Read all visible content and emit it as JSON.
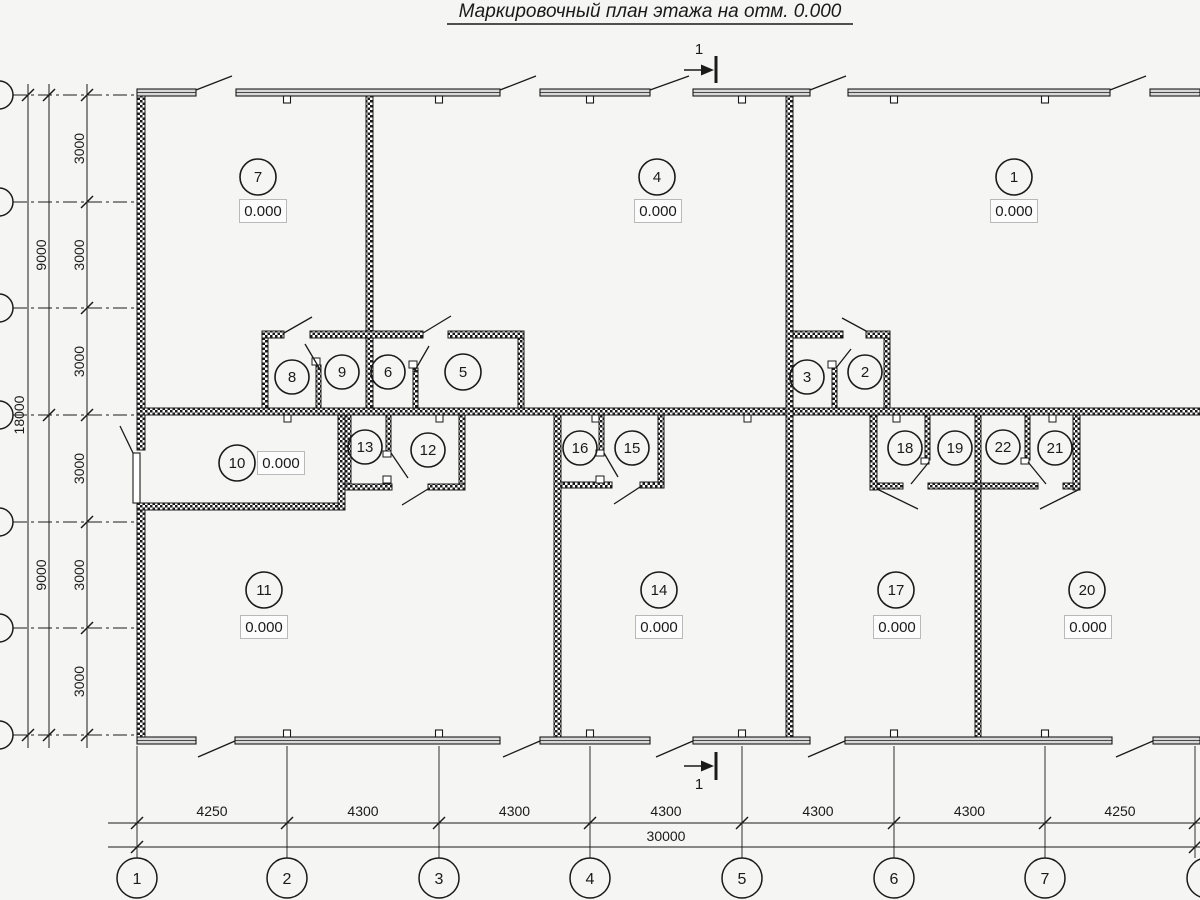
{
  "title": "Маркировочный план этажа на отм. 0.000",
  "section_mark": {
    "label": "1"
  },
  "colors": {
    "background": "#f5f5f3",
    "line": "#1a1a1a",
    "band_fill": "#d8d8d8",
    "elevation_box_fill": "#fcfcfc",
    "elevation_box_border": "#b9b9b9"
  },
  "rooms": [
    {
      "number": "7",
      "cx": 258,
      "cy": 177,
      "r": 18,
      "elevation": "0.000",
      "ex": 263,
      "ey": 211
    },
    {
      "number": "4",
      "cx": 657,
      "cy": 177,
      "r": 18,
      "elevation": "0.000",
      "ex": 658,
      "ey": 211
    },
    {
      "number": "1",
      "cx": 1014,
      "cy": 177,
      "r": 18,
      "elevation": "0.000",
      "ex": 1014,
      "ey": 211
    },
    {
      "number": "8",
      "cx": 292,
      "cy": 377,
      "r": 17
    },
    {
      "number": "9",
      "cx": 342,
      "cy": 372,
      "r": 17
    },
    {
      "number": "6",
      "cx": 388,
      "cy": 372,
      "r": 17
    },
    {
      "number": "5",
      "cx": 463,
      "cy": 372,
      "r": 18
    },
    {
      "number": "3",
      "cx": 807,
      "cy": 377,
      "r": 17
    },
    {
      "number": "2",
      "cx": 865,
      "cy": 372,
      "r": 17
    },
    {
      "number": "10",
      "cx": 237,
      "cy": 463,
      "r": 18,
      "elevation": "0.000",
      "ex": 281,
      "ey": 463
    },
    {
      "number": "13",
      "cx": 365,
      "cy": 447,
      "r": 17
    },
    {
      "number": "12",
      "cx": 428,
      "cy": 450,
      "r": 17
    },
    {
      "number": "16",
      "cx": 580,
      "cy": 448,
      "r": 17
    },
    {
      "number": "15",
      "cx": 632,
      "cy": 448,
      "r": 17
    },
    {
      "number": "18",
      "cx": 905,
      "cy": 448,
      "r": 17
    },
    {
      "number": "19",
      "cx": 955,
      "cy": 448,
      "r": 17
    },
    {
      "number": "22",
      "cx": 1003,
      "cy": 447,
      "r": 17
    },
    {
      "number": "21",
      "cx": 1055,
      "cy": 448,
      "r": 17
    },
    {
      "number": "11",
      "cx": 264,
      "cy": 590,
      "r": 18,
      "elevation": "0.000",
      "ex": 264,
      "ey": 627
    },
    {
      "number": "14",
      "cx": 659,
      "cy": 590,
      "r": 18,
      "elevation": "0.000",
      "ex": 659,
      "ey": 627
    },
    {
      "number": "17",
      "cx": 896,
      "cy": 590,
      "r": 18,
      "elevation": "0.000",
      "ex": 897,
      "ey": 627
    },
    {
      "number": "20",
      "cx": 1087,
      "cy": 590,
      "r": 18,
      "elevation": "0.000",
      "ex": 1088,
      "ey": 627
    }
  ],
  "left_axes": {
    "rows_y": [
      95,
      202,
      308,
      415,
      522,
      628,
      735
    ],
    "cx": -1,
    "r": 14
  },
  "left_dimensions": {
    "inner": {
      "x": 87,
      "label_x": 84,
      "labels": [
        "3000",
        "3000",
        "3000",
        "3000",
        "3000",
        "3000"
      ]
    },
    "middle": {
      "x": 49,
      "label_x": 46,
      "spans": [
        {
          "label": "9000",
          "y1": 95,
          "y2": 415
        },
        {
          "label": "9000",
          "y1": 415,
          "y2": 735
        }
      ]
    },
    "outer": {
      "x": 28,
      "label_x": 24,
      "label": "18000",
      "label_y": 415
    }
  },
  "bottom_axes": {
    "cy": 878,
    "r": 20,
    "circles": [
      {
        "label": "1",
        "x": 137
      },
      {
        "label": "2",
        "x": 287
      },
      {
        "label": "3",
        "x": 439
      },
      {
        "label": "4",
        "x": 590
      },
      {
        "label": "5",
        "x": 742
      },
      {
        "label": "6",
        "x": 894
      },
      {
        "label": "7",
        "x": 1045
      },
      {
        "label": "",
        "x": 1207,
        "line_x": 1195
      }
    ]
  },
  "bottom_dimensions": {
    "line_y": 823,
    "total_line_y": 847,
    "axis_x": [
      137,
      287,
      439,
      590,
      742,
      894,
      1045,
      1195
    ],
    "segments": [
      {
        "label": "4250",
        "x1": 137,
        "x2": 287
      },
      {
        "label": "4300",
        "x1": 287,
        "x2": 439
      },
      {
        "label": "4300",
        "x1": 439,
        "x2": 590
      },
      {
        "label": "4300",
        "x1": 590,
        "x2": 742
      },
      {
        "label": "4300",
        "x1": 742,
        "x2": 894
      },
      {
        "label": "4300",
        "x1": 894,
        "x2": 1045
      },
      {
        "label": "4250",
        "x1": 1045,
        "x2": 1195
      }
    ],
    "total": {
      "label": "30000",
      "label_x": 666
    }
  }
}
